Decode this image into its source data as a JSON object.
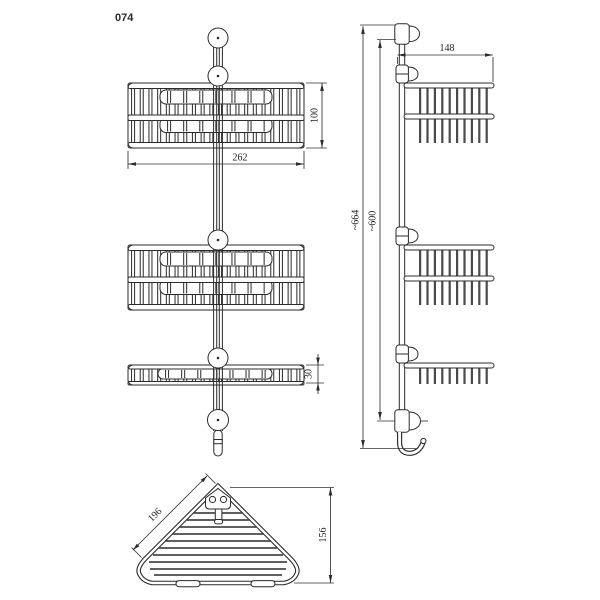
{
  "drawing": {
    "model_number": "074",
    "front_view": {
      "dim_width": "262",
      "dim_basket_height": "100",
      "dim_tray_height": "30"
    },
    "side_view": {
      "dim_depth": "148",
      "dim_overall_height": "~664",
      "dim_rail_height": "~600"
    },
    "top_view": {
      "dim_edge_length": "196",
      "dim_depth": "156"
    }
  }
}
